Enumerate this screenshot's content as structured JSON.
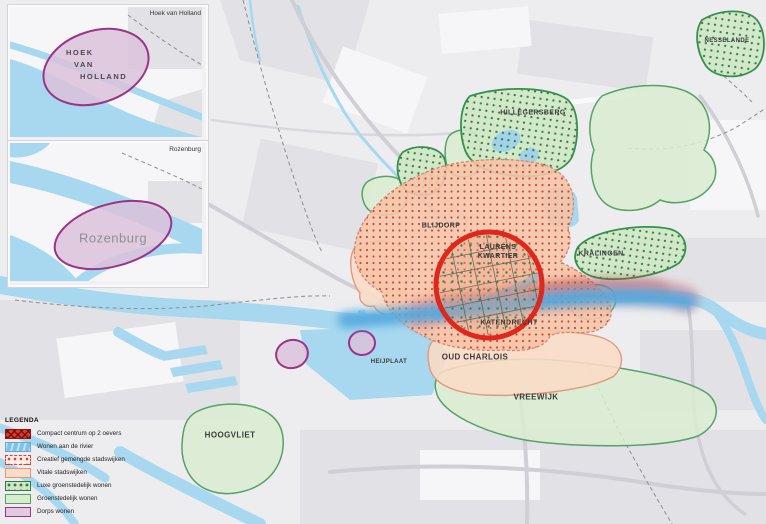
{
  "insets": [
    {
      "corner_label": "Hoek van Holland",
      "area_lines": [
        "HOEK",
        "VAN",
        "HOLLAND"
      ]
    },
    {
      "corner_label": "Rozenburg",
      "area_label": "Rozenburg"
    }
  ],
  "legend": {
    "title": "LEGENDA",
    "items": [
      {
        "id": "compact-centrum",
        "label": "Compact centrum op 2 oevers"
      },
      {
        "id": "wonen-rivier",
        "label": "Wonen aan de rivier"
      },
      {
        "id": "creatief",
        "label": "Creatief gemengde stadswijken"
      },
      {
        "id": "vitale",
        "label": "Vitale stadswijken"
      },
      {
        "id": "luxe-groen",
        "label": "Luxe groenstedelijk wonen"
      },
      {
        "id": "groen",
        "label": "Groenstedelijk wonen"
      },
      {
        "id": "dorps",
        "label": "Dorps wonen"
      }
    ]
  },
  "map": {
    "labels": {
      "blijdorp": "BLIJDORP",
      "laurens_line1": "LAURENS",
      "laurens_line2": "KWARTIER",
      "katendrecht": "KATENDRECHT",
      "oud_charlois": "OUD CHARLOIS",
      "hillegersberg": "HILLEGERSBERG",
      "kralingen": "KRALINGEN",
      "nesselande": "NESSELANDE",
      "vreewijk": "VREEWIJK",
      "heijplaat": "HEIJPLAAT",
      "hoogvliet": "HOOGVLIET"
    }
  },
  "colors": {
    "water": "#a7d8ef",
    "land": "#ededf0",
    "land_dark": "#e2e2e6",
    "road": "#cfcfd5",
    "compact_red": "#e0271c",
    "creatief_fill": "#f4c5a9",
    "creatief_dot": "#d6453a",
    "vitale_fill": "#f8dcc7",
    "vitale_border": "#e2997a",
    "luxe_fill": "#cfe7c5",
    "luxe_dot": "#2f7d46",
    "luxe_border": "#35914d",
    "groen_fill": "#d9ecd0",
    "groen_border": "#57a169",
    "dorps_fill": "#dcc2db",
    "dorps_border": "#9a3489",
    "rivier_blue": "#55aadf",
    "rivier_red": "#c84b44",
    "label_color": "#3b3b3b"
  }
}
